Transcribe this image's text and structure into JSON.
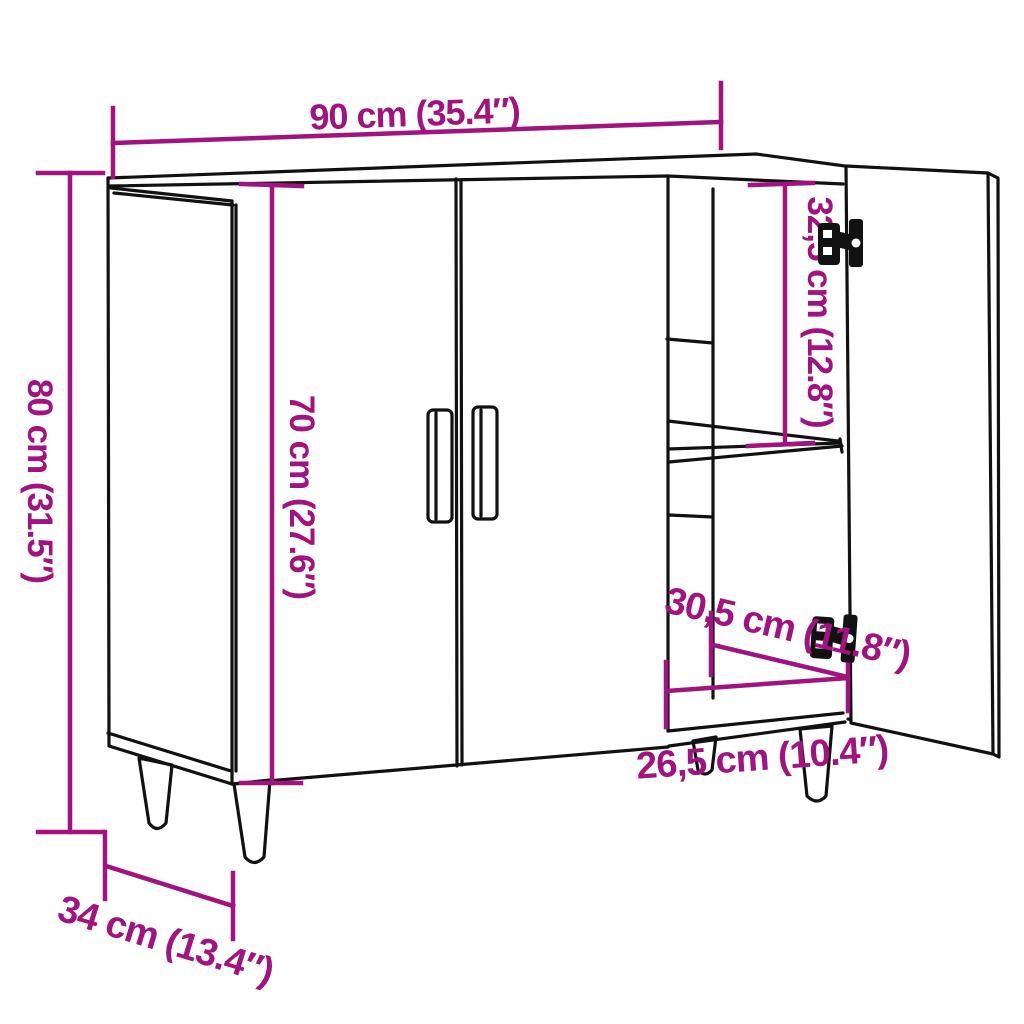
{
  "colors": {
    "background": "#FFFFFF",
    "line": "#111111",
    "dimension": "#A1137E"
  },
  "dimensions": {
    "width": {
      "label": "90 cm (35.4″)"
    },
    "height": {
      "label": "80 cm (31.5″)"
    },
    "door_height": {
      "label": "70 cm (27.6″)"
    },
    "top_compartment": {
      "label": "32,5 cm (12.8″)"
    },
    "bottom_depth": {
      "label": "30,5 cm (11.8″)"
    },
    "bottom_width": {
      "label": "26,5 cm (10.4″)"
    },
    "depth": {
      "label": "34 cm (13.4″)"
    }
  }
}
